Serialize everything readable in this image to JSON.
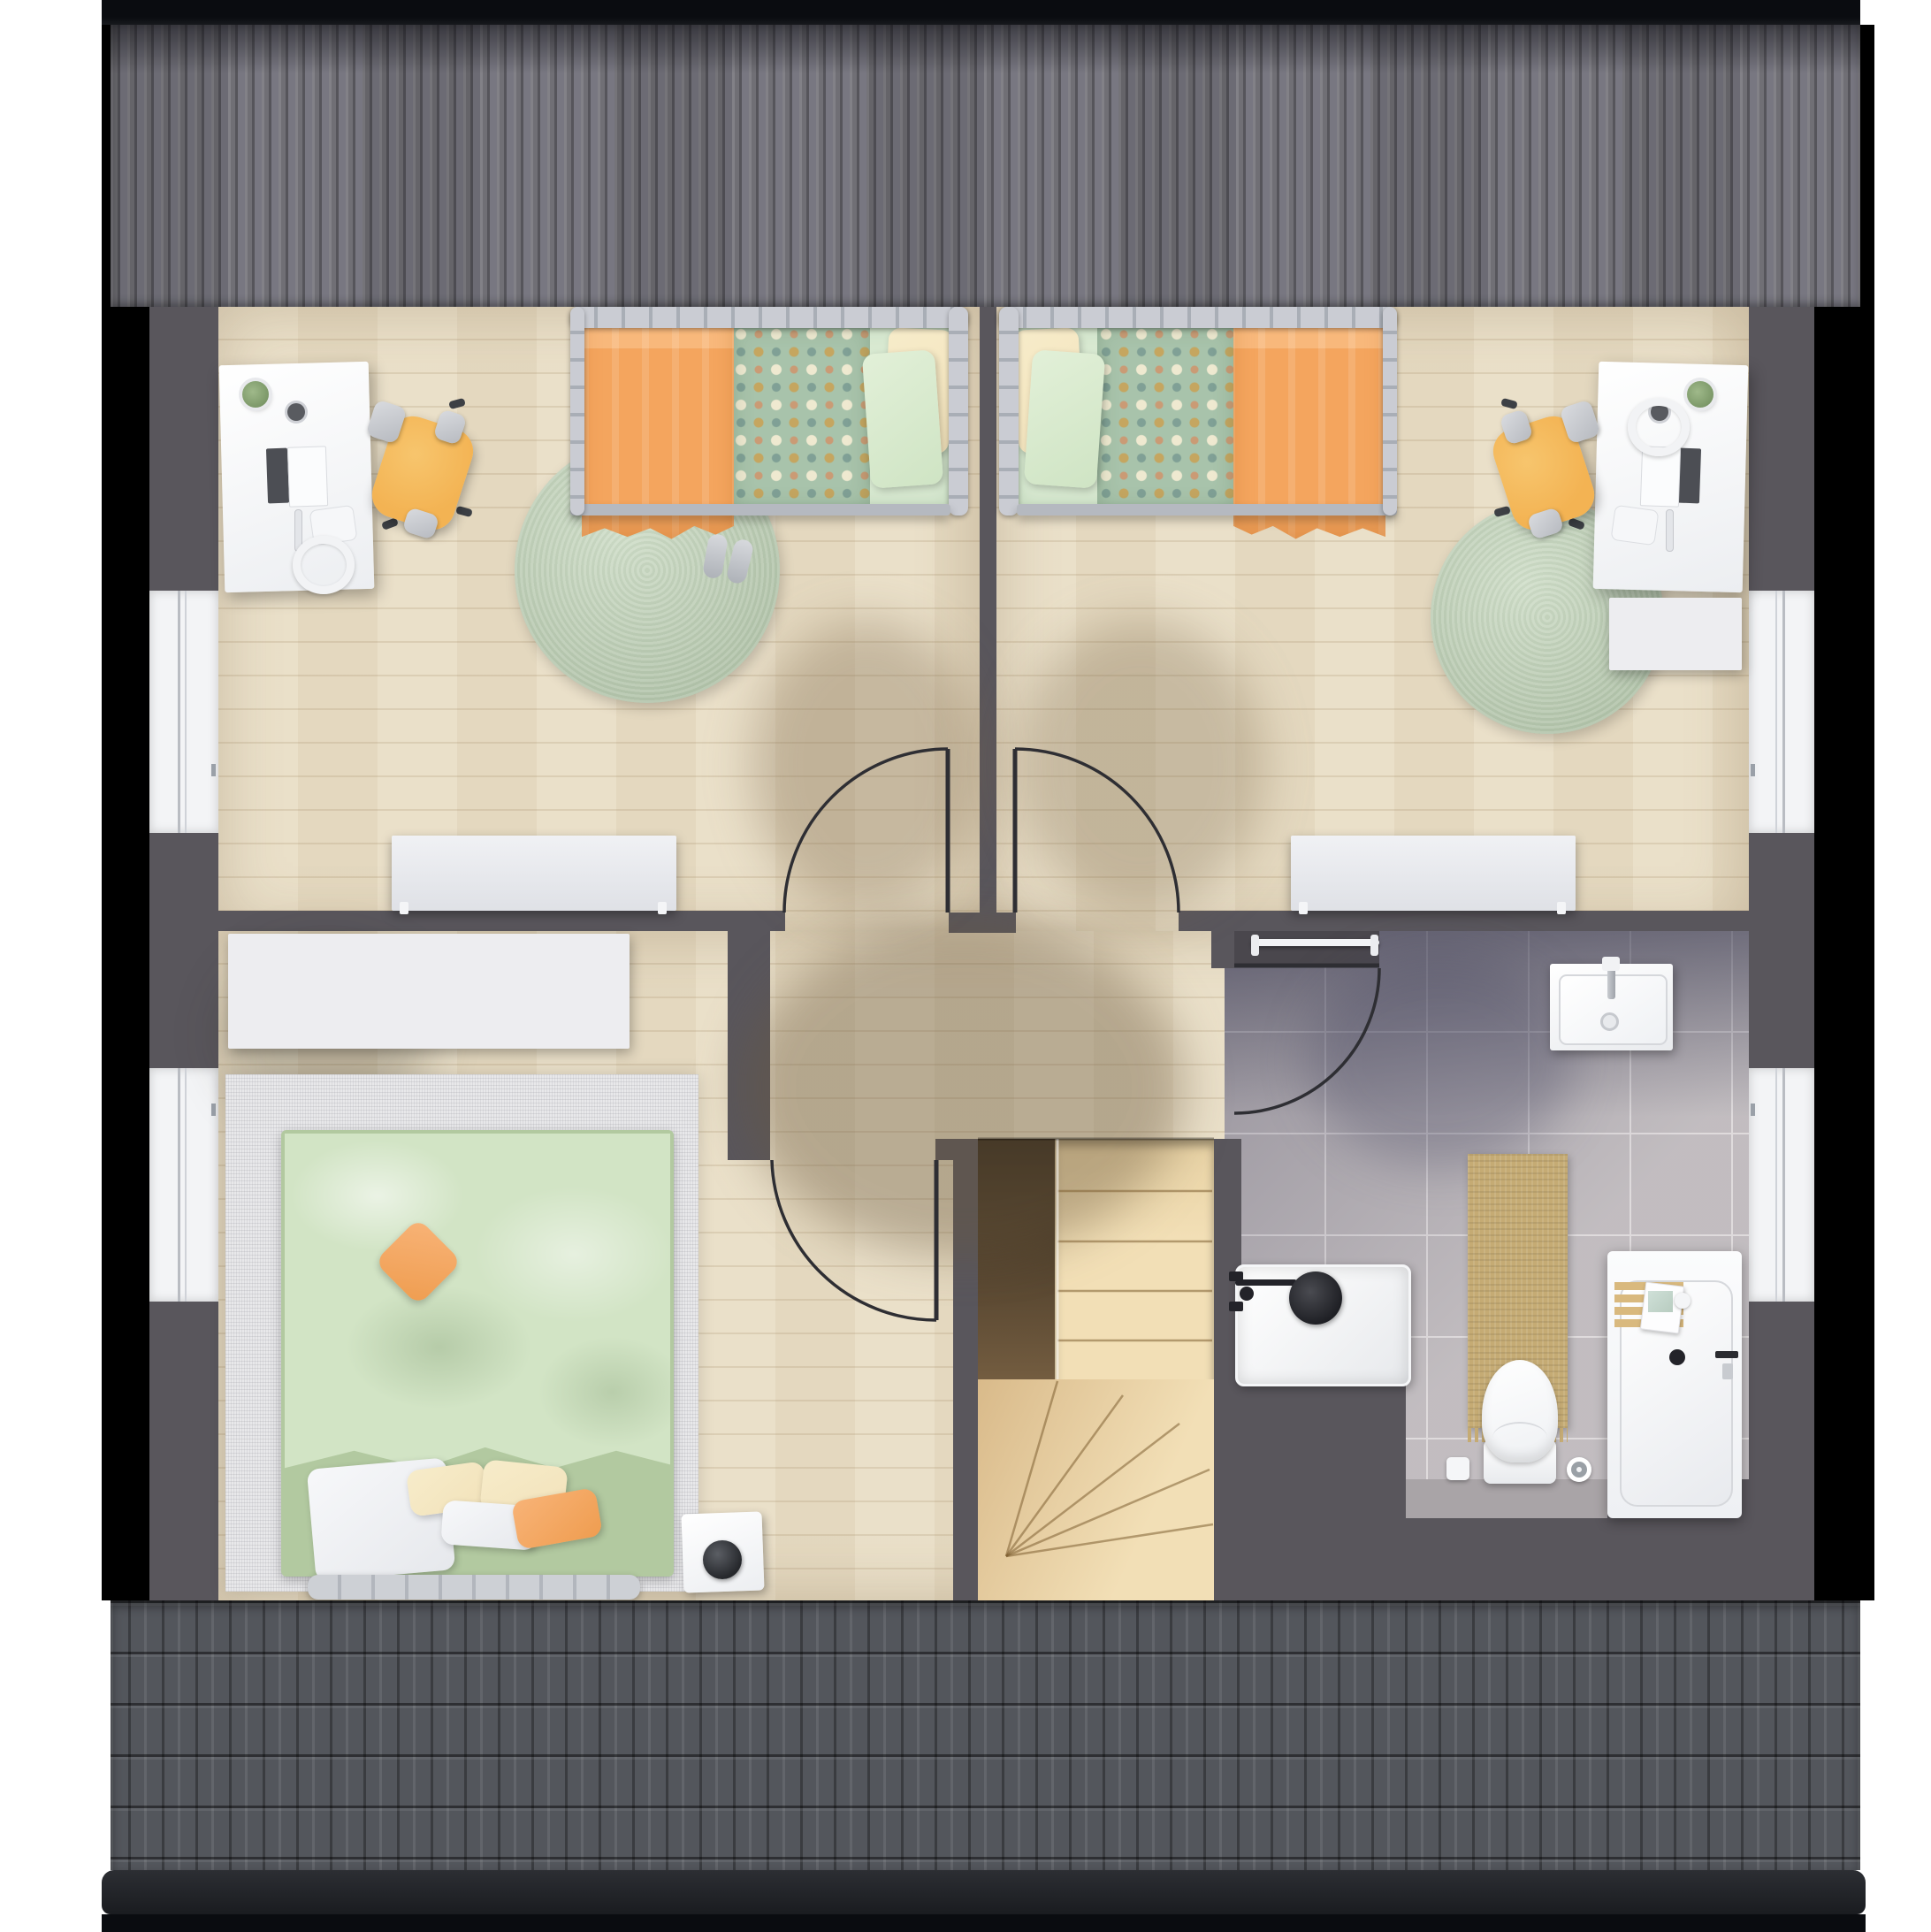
{
  "title": "attic-floor-plan-top-view",
  "palette": {
    "page_bg": "#ffffff",
    "frame_black": "#0a0c10",
    "roof_top_base": "#76757b",
    "roof_bottom_base": "#53565c",
    "wall": "#59565c",
    "wood": "#e9dec6",
    "tile": "#b4aeb2",
    "tile_grout": "#d8d3d5",
    "white_furniture": "#ededf0",
    "rug_green": "#c7d8bf",
    "rug_gray": "#e8e8ea",
    "orange": "#f4a55e",
    "duvet_polka": "#a8c3ab",
    "sheet_green": "#d8e9d1",
    "pillow_cream": "#f2e2ba",
    "master_duvet": "#d2e4c5",
    "master_base": "#b2c9a0",
    "bed_frame_gray": "#c0c3ca",
    "chair_orange": "#f3b353",
    "stairs_cream": "#f2dfb6",
    "stairs_tan": "#d9ba8a",
    "stair_void_dark": "#32281b",
    "stair_void_light": "#7a6244",
    "mat_tan": "#c5ab74",
    "fixture_black": "#232329",
    "door_line": "#2e2e33"
  },
  "plan": {
    "rooms": [
      {
        "name": "kids-bedroom-left",
        "floor": "wood"
      },
      {
        "name": "kids-bedroom-right",
        "floor": "wood"
      },
      {
        "name": "master-bedroom",
        "floor": "wood"
      },
      {
        "name": "hallway",
        "floor": "wood"
      },
      {
        "name": "bathroom",
        "floor": "gray-tiles"
      }
    ],
    "doors": 4,
    "windows": 4,
    "stairs": {
      "type": "winder",
      "straight_treads": 5,
      "fan_treads": 4
    },
    "furniture": [
      "single-bed-left",
      "single-bed-right",
      "double-bed",
      "desk-left",
      "desk-right",
      "desk-chair-left",
      "desk-chair-right",
      "round-rug-left",
      "round-rug-right",
      "bedroom-rug",
      "radiator-left-room",
      "radiator-right-room",
      "wardrobe",
      "sideboard",
      "night-table-speaker",
      "washbasin",
      "shower",
      "toilet",
      "bathtub",
      "bath-mat",
      "towel-rail"
    ]
  }
}
